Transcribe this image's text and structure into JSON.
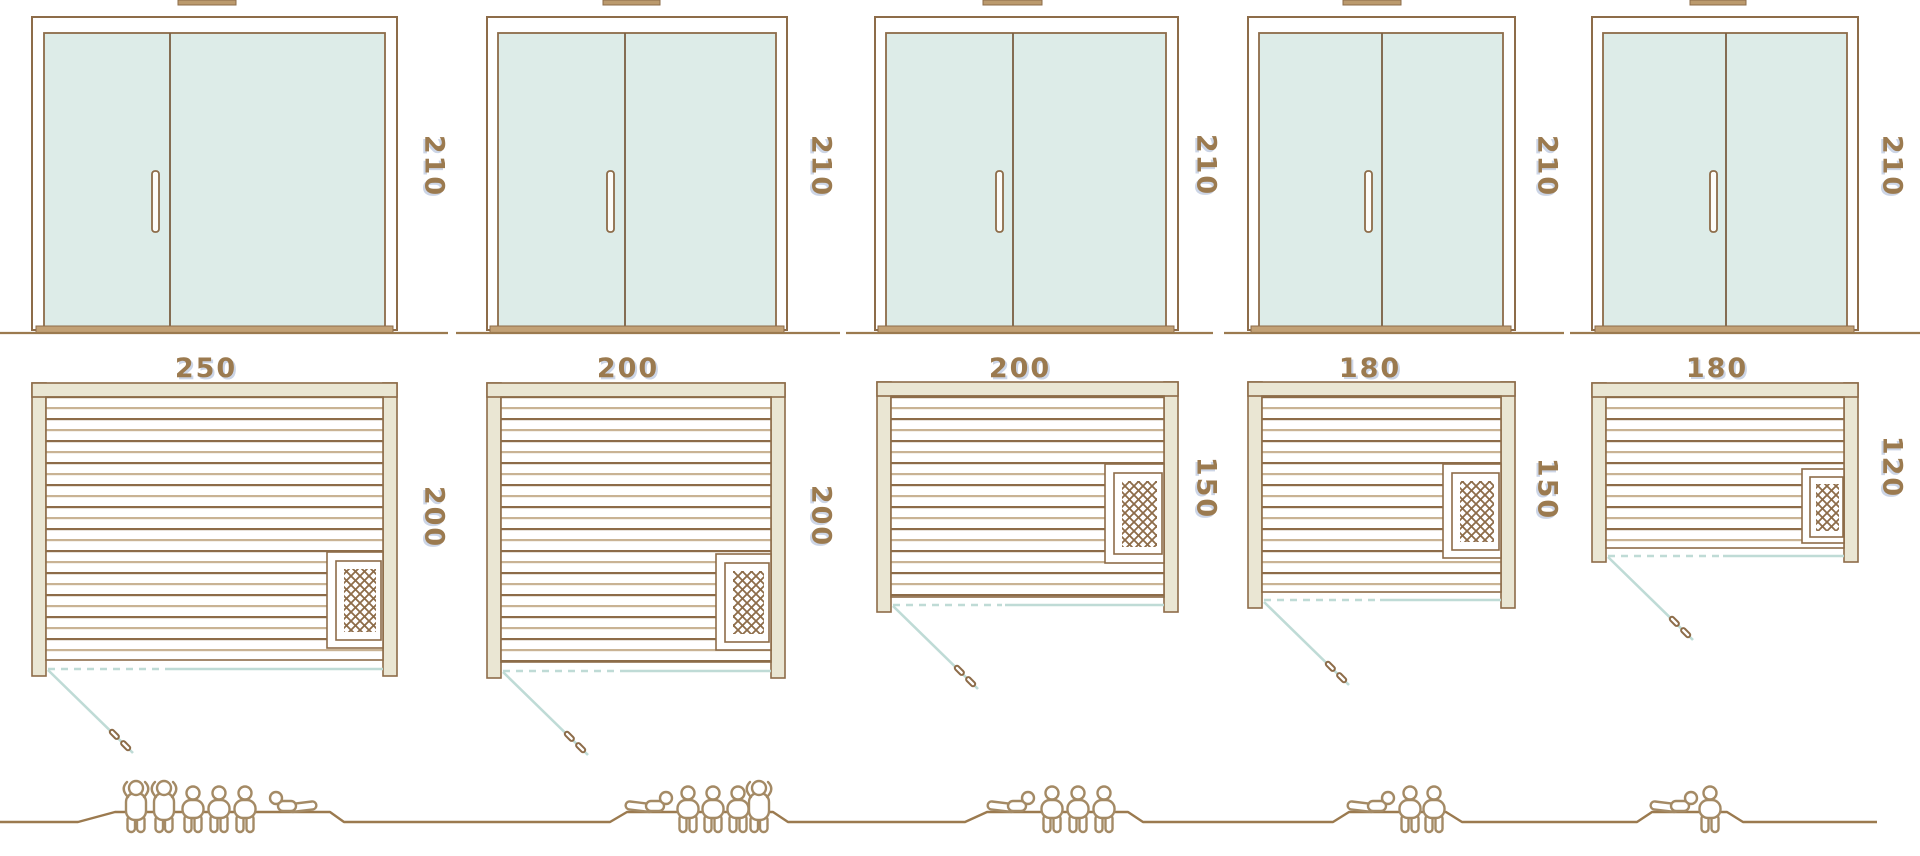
{
  "palette": {
    "outline_brown": "#8d6c49",
    "slat_tan": "#c9b394",
    "frame_cream": "#eae6d3",
    "glass_mint": "#ddece8",
    "door_swing_teal": "#bfdbd6",
    "dimension_text": "#9b7a4f",
    "figure_outline": "#a48a65",
    "sill_tan": "#c2a176"
  },
  "units": [
    {
      "door_height_cm": "210",
      "width_cm": "250",
      "depth_cm": "200",
      "capacity_standing": 2,
      "capacity_sitting": 3,
      "capacity_lying": 1
    },
    {
      "door_height_cm": "210",
      "width_cm": "200",
      "depth_cm": "200",
      "capacity_standing": 1,
      "capacity_sitting": 3,
      "capacity_lying": 1
    },
    {
      "door_height_cm": "210",
      "width_cm": "200",
      "depth_cm": "150",
      "capacity_standing": 0,
      "capacity_sitting": 3,
      "capacity_lying": 1
    },
    {
      "door_height_cm": "210",
      "width_cm": "180",
      "depth_cm": "150",
      "capacity_standing": 0,
      "capacity_sitting": 2,
      "capacity_lying": 1
    },
    {
      "door_height_cm": "210",
      "width_cm": "180",
      "depth_cm": "120",
      "capacity_standing": 0,
      "capacity_sitting": 1,
      "capacity_lying": 1
    }
  ]
}
